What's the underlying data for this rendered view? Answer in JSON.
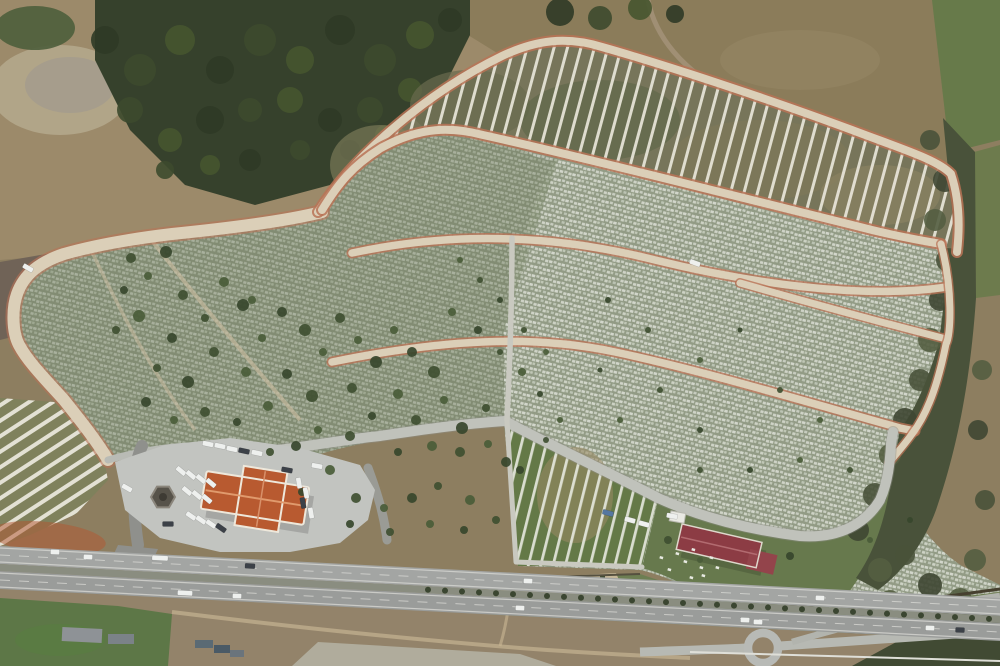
{
  "scene": {
    "description": "Aerial drone photograph of a large hillside cemetery: terraced rows of graves, curving tan service roads with reddish edges, empty striped burial plots, an administration building with an orange hip roof beside a parking plaza, a second maroon-roofed building, and a divided highway with traffic running along the bottom.",
    "colors": {
      "base": "#8d7e60",
      "dirt": "#9c8a6a",
      "dirt_light": "#b7ab90",
      "rubble": "#a19a8f",
      "purple_soil": "#6d6057",
      "forest": "#36412c",
      "grass_patch": "#5e7244",
      "field": "#8b7c5a",
      "field_green": "#677a4a",
      "scrub": "#49523a",
      "band_soil": "#77755a",
      "stripe_white": "#ebe8dc",
      "cem_base": "#8b947f",
      "cem_dense": "#a0a893",
      "left_tint": "#6d7b57",
      "road_tan": "#dbcfb8",
      "road_edge": "#b97356",
      "gray_road": "#c0c2bb",
      "small_path": "#c9c9c0",
      "plaza": "#c2c4c0",
      "asphalt": "#8f908c",
      "highway": "#a3a5a3",
      "highway_b": "#9a9c9a",
      "median": "#8a8d80",
      "lane": "#d6d6d2",
      "roof_orange": "#b85a30",
      "roof_ridge": "#e09a6d",
      "roof_maroon": "#8c3c44",
      "maroon_ridge": "#b26b70",
      "kiosk": "#57534a",
      "lawn": "#67794d",
      "slope": "#6d7e52",
      "sparse_green": "#647947",
      "wall": "#46402f",
      "fence": "#55503f",
      "shed": "#8e9296",
      "field_bottom": "#5d7747",
      "pale_patch": "#b5b4a4",
      "red_dirt": "#b4552f",
      "court": "#c6b898",
      "track": "#c9b795",
      "guardrail": "#dfdfd8"
    },
    "tree_palette": [
      "#3f4f31",
      "#4a5c38",
      "#37462c"
    ],
    "forest_palette": [
      "#2f3a26",
      "#3d4a2e",
      "#46552f"
    ],
    "scrub_palette": [
      "#49523a",
      "#3f4733",
      "#545e41"
    ],
    "vehicle_palette": [
      "#eef0ee",
      "#3c4148",
      "#5577a0"
    ],
    "trees": [
      [
        131,
        258,
        5
      ],
      [
        148,
        276,
        4
      ],
      [
        166,
        252,
        6
      ],
      [
        183,
        295,
        5
      ],
      [
        139,
        316,
        6
      ],
      [
        172,
        338,
        5
      ],
      [
        205,
        318,
        4
      ],
      [
        224,
        282,
        5
      ],
      [
        243,
        305,
        6
      ],
      [
        214,
        352,
        5
      ],
      [
        246,
        372,
        5
      ],
      [
        188,
        382,
        6
      ],
      [
        157,
        368,
        4
      ],
      [
        262,
        338,
        4
      ],
      [
        282,
        312,
        5
      ],
      [
        305,
        330,
        6
      ],
      [
        323,
        352,
        4
      ],
      [
        287,
        374,
        5
      ],
      [
        312,
        396,
        6
      ],
      [
        268,
        406,
        5
      ],
      [
        237,
        422,
        4
      ],
      [
        205,
        412,
        5
      ],
      [
        174,
        420,
        4
      ],
      [
        146,
        402,
        5
      ],
      [
        340,
        318,
        5
      ],
      [
        358,
        340,
        4
      ],
      [
        376,
        362,
        6
      ],
      [
        352,
        388,
        5
      ],
      [
        394,
        330,
        4
      ],
      [
        412,
        352,
        5
      ],
      [
        434,
        372,
        6
      ],
      [
        398,
        394,
        5
      ],
      [
        372,
        416,
        4
      ],
      [
        416,
        420,
        5
      ],
      [
        444,
        400,
        4
      ],
      [
        462,
        428,
        6
      ],
      [
        486,
        408,
        4
      ],
      [
        432,
        446,
        5
      ],
      [
        398,
        452,
        4
      ],
      [
        460,
        452,
        5
      ],
      [
        488,
        444,
        4
      ],
      [
        506,
        462,
        5
      ],
      [
        350,
        436,
        5
      ],
      [
        318,
        430,
        4
      ],
      [
        296,
        446,
        5
      ],
      [
        270,
        452,
        4
      ],
      [
        330,
        470,
        5
      ],
      [
        302,
        492,
        4
      ],
      [
        356,
        498,
        5
      ],
      [
        384,
        508,
        4
      ],
      [
        412,
        498,
        5
      ],
      [
        438,
        486,
        4
      ],
      [
        470,
        500,
        5
      ],
      [
        350,
        524,
        4
      ],
      [
        390,
        532,
        4
      ],
      [
        430,
        524,
        4
      ],
      [
        464,
        530,
        4
      ],
      [
        496,
        520,
        4
      ],
      [
        252,
        300,
        4
      ],
      [
        124,
        290,
        4
      ],
      [
        116,
        330,
        4
      ],
      [
        452,
        312,
        4
      ],
      [
        478,
        330,
        4
      ],
      [
        500,
        352,
        3
      ],
      [
        522,
        372,
        4
      ],
      [
        540,
        394,
        3
      ],
      [
        524,
        330,
        3
      ],
      [
        546,
        352,
        3
      ],
      [
        500,
        300,
        3
      ],
      [
        480,
        280,
        3
      ],
      [
        460,
        260,
        3
      ],
      [
        520,
        470,
        4
      ],
      [
        546,
        440,
        3
      ],
      [
        560,
        420,
        3
      ],
      [
        608,
        300,
        3
      ],
      [
        648,
        330,
        3
      ],
      [
        700,
        360,
        3
      ],
      [
        740,
        330,
        2.5
      ],
      [
        780,
        390,
        3
      ],
      [
        820,
        420,
        3
      ],
      [
        700,
        430,
        3
      ],
      [
        660,
        390,
        3
      ],
      [
        620,
        420,
        3
      ],
      [
        600,
        370,
        2.5
      ],
      [
        850,
        470,
        3
      ],
      [
        800,
        460,
        3
      ],
      [
        750,
        470,
        3
      ],
      [
        700,
        470,
        3
      ],
      [
        870,
        540,
        3
      ],
      [
        910,
        520,
        3
      ],
      [
        668,
        540,
        4
      ],
      [
        700,
        560,
        3
      ],
      [
        790,
        556,
        4
      ],
      [
        640,
        600,
        3
      ]
    ],
    "forest_blobs": [
      [
        105,
        40,
        14
      ],
      [
        140,
        70,
        16
      ],
      [
        180,
        40,
        15
      ],
      [
        220,
        70,
        14
      ],
      [
        260,
        40,
        16
      ],
      [
        300,
        60,
        14
      ],
      [
        340,
        30,
        15
      ],
      [
        380,
        60,
        16
      ],
      [
        420,
        35,
        14
      ],
      [
        450,
        20,
        12
      ],
      [
        130,
        110,
        13
      ],
      [
        170,
        140,
        12
      ],
      [
        210,
        120,
        14
      ],
      [
        250,
        110,
        12
      ],
      [
        290,
        100,
        13
      ],
      [
        330,
        120,
        12
      ],
      [
        370,
        110,
        13
      ],
      [
        410,
        90,
        12
      ],
      [
        250,
        160,
        11
      ],
      [
        300,
        150,
        10
      ],
      [
        210,
        165,
        10
      ],
      [
        350,
        150,
        10
      ],
      [
        165,
        170,
        9
      ],
      [
        385,
        135,
        10
      ],
      [
        560,
        12,
        14
      ],
      [
        600,
        18,
        12
      ],
      [
        640,
        8,
        12
      ],
      [
        675,
        14,
        9
      ]
    ],
    "scrub_blobs": [
      [
        930,
        140,
        10
      ],
      [
        945,
        180,
        12
      ],
      [
        935,
        220,
        11
      ],
      [
        948,
        260,
        12
      ],
      [
        940,
        300,
        11
      ],
      [
        930,
        340,
        12
      ],
      [
        920,
        380,
        11
      ],
      [
        905,
        420,
        12
      ],
      [
        890,
        455,
        11
      ],
      [
        875,
        495,
        12
      ],
      [
        858,
        530,
        11
      ],
      [
        880,
        570,
        12
      ],
      [
        905,
        555,
        10
      ],
      [
        930,
        585,
        12
      ],
      [
        960,
        600,
        12
      ],
      [
        990,
        615,
        12
      ],
      [
        940,
        620,
        11
      ],
      [
        890,
        600,
        10
      ],
      [
        855,
        640,
        12
      ],
      [
        900,
        640,
        12
      ],
      [
        950,
        645,
        12
      ],
      [
        990,
        645,
        10
      ],
      [
        865,
        612,
        9
      ],
      [
        975,
        560,
        11
      ],
      [
        985,
        500,
        10
      ],
      [
        978,
        430,
        10
      ],
      [
        982,
        370,
        10
      ]
    ],
    "bush_rows": [
      [
        140,
        560,
        640,
        592,
        22
      ],
      [
        520,
        646,
        990,
        627,
        26
      ]
    ],
    "median_trees": {
      "x_start": 428,
      "x_end": 995,
      "step": 17,
      "y0": 567.5,
      "slope": 0.052,
      "r": 3
    },
    "parked_vehicles": [
      [
        208,
        444,
        12,
        0
      ],
      [
        220,
        446,
        12,
        0
      ],
      [
        232,
        449,
        12,
        0
      ],
      [
        244,
        451,
        12,
        1
      ],
      [
        257,
        453,
        12,
        0
      ],
      [
        181,
        471,
        40,
        0
      ],
      [
        191,
        475,
        40,
        0
      ],
      [
        201,
        479,
        40,
        0
      ],
      [
        211,
        483,
        40,
        0
      ],
      [
        187,
        491,
        40,
        0
      ],
      [
        197,
        495,
        40,
        0
      ],
      [
        207,
        499,
        40,
        0
      ],
      [
        191,
        516,
        35,
        0
      ],
      [
        201,
        520,
        35,
        0
      ],
      [
        211,
        524,
        35,
        0
      ],
      [
        221,
        528,
        35,
        1
      ],
      [
        168,
        524,
        0,
        1
      ],
      [
        299,
        483,
        80,
        0
      ],
      [
        306,
        493,
        80,
        0
      ],
      [
        303,
        503,
        80,
        1
      ],
      [
        311,
        513,
        80,
        0
      ],
      [
        317,
        466,
        10,
        0
      ],
      [
        287,
        470,
        10,
        1
      ],
      [
        127,
        488,
        30,
        0
      ],
      [
        630,
        520,
        15,
        0
      ],
      [
        644,
        524,
        15,
        0
      ],
      [
        608,
        513,
        15,
        2
      ],
      [
        672,
        516,
        10,
        0
      ],
      [
        695,
        263,
        20,
        0
      ],
      [
        28,
        268,
        30,
        0
      ]
    ],
    "highway_vehicles": [
      [
        55,
        552,
        0,
        9
      ],
      [
        88,
        557,
        0,
        9
      ],
      [
        160,
        558,
        0,
        16
      ],
      [
        250,
        566,
        1,
        10
      ],
      [
        528,
        581,
        0,
        9
      ],
      [
        820,
        598,
        0,
        9
      ],
      [
        185,
        593,
        0,
        15
      ],
      [
        237,
        596,
        0,
        9
      ],
      [
        520,
        608,
        0,
        9
      ],
      [
        745,
        620,
        0,
        9
      ],
      [
        758,
        622,
        0,
        9
      ],
      [
        930,
        628,
        0,
        9
      ],
      [
        960,
        630,
        1,
        9
      ]
    ],
    "lawn_graves": [
      [
        676,
        552
      ],
      [
        684,
        560
      ],
      [
        692,
        548
      ],
      [
        700,
        566
      ],
      [
        710,
        556
      ],
      [
        668,
        568
      ],
      [
        690,
        576
      ],
      [
        702,
        574
      ],
      [
        660,
        556
      ],
      [
        716,
        566
      ]
    ]
  }
}
